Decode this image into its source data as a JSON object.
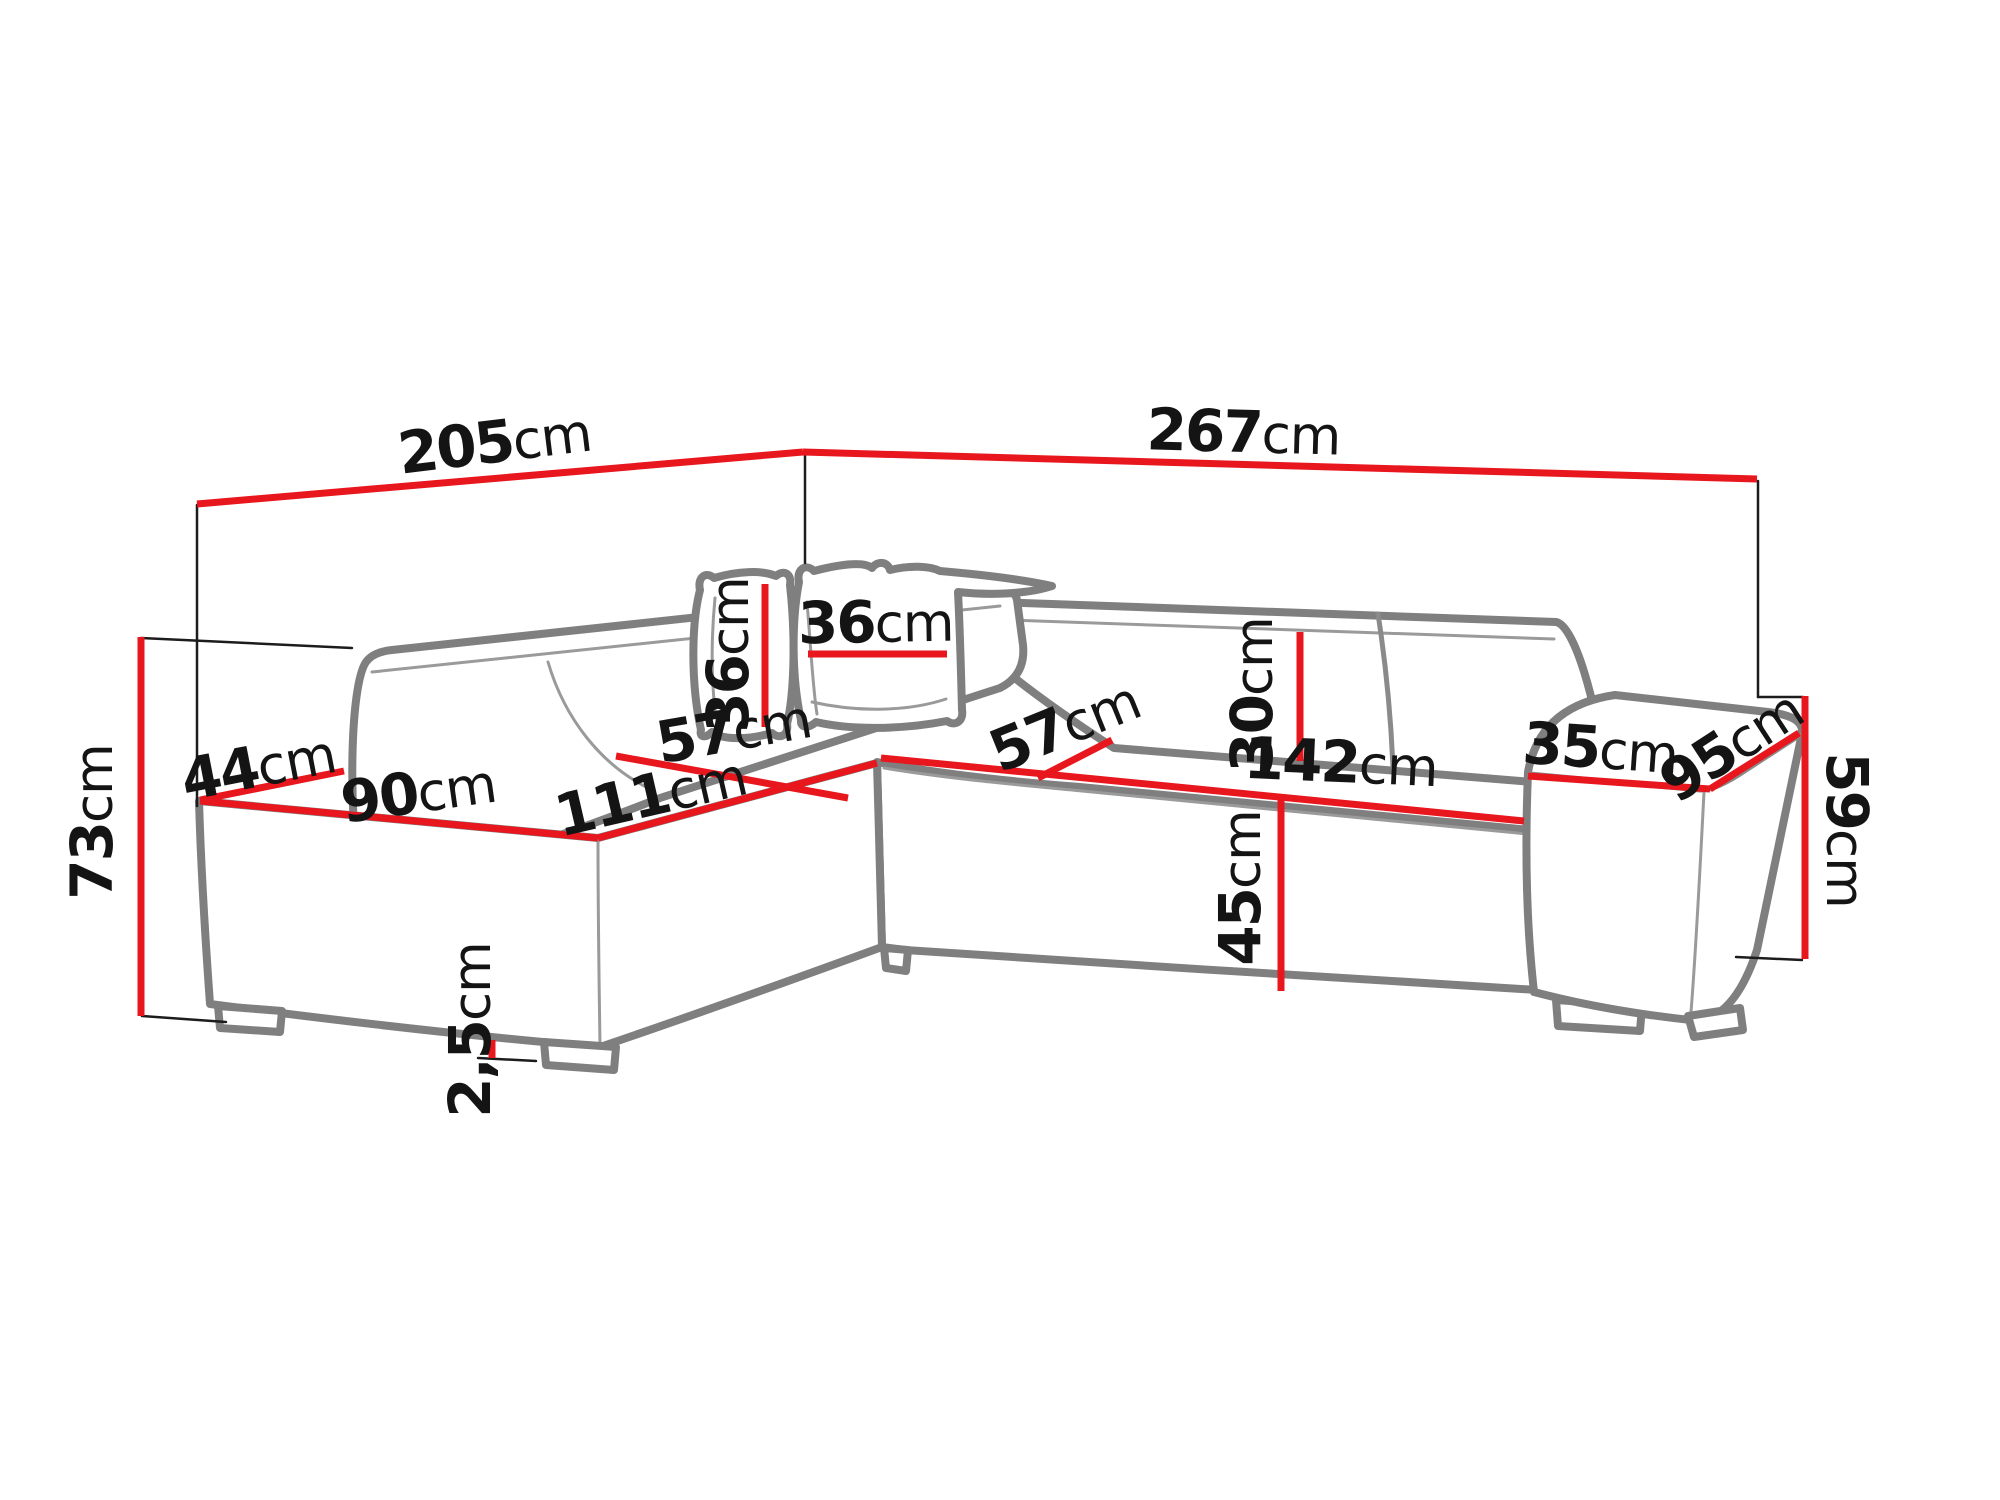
{
  "page": {
    "background": "#ffffff"
  },
  "diagram": {
    "name": "corner-sofa-dimension-drawing",
    "unit": "cm",
    "colors": {
      "dimension_line": "#e8161d",
      "sketch_outline": "#7f7f7f",
      "extension_line": "#1c1c1c",
      "label_text": "#141414"
    },
    "labels": {
      "back_left_width": {
        "num": "205",
        "unit": "cm"
      },
      "back_right_width": {
        "num": "267",
        "unit": "cm"
      },
      "total_height": {
        "num": "73",
        "unit": "cm"
      },
      "left_arm_top_depth": {
        "num": "44",
        "unit": "cm"
      },
      "left_seat_width": {
        "num": "90",
        "unit": "cm"
      },
      "chaise_seat_length": {
        "num": "111",
        "unit": "cm"
      },
      "left_seat_depth": {
        "num": "57",
        "unit": "cm"
      },
      "pillow_height": {
        "num": "36",
        "unit": "cm"
      },
      "pillow_width": {
        "num": "36",
        "unit": "cm"
      },
      "right_seat_depth": {
        "num": "57",
        "unit": "cm"
      },
      "backrest_cushion_height": {
        "num": "30",
        "unit": "cm"
      },
      "right_seat_width": {
        "num": "142",
        "unit": "cm"
      },
      "seat_front_height": {
        "num": "45",
        "unit": "cm"
      },
      "right_arm_top_width": {
        "num": "35",
        "unit": "cm"
      },
      "right_arm_depth": {
        "num": "95",
        "unit": "cm"
      },
      "right_arm_height": {
        "num": "59",
        "unit": "cm"
      },
      "leg_height": {
        "num": "2,5",
        "unit": "cm"
      }
    }
  }
}
